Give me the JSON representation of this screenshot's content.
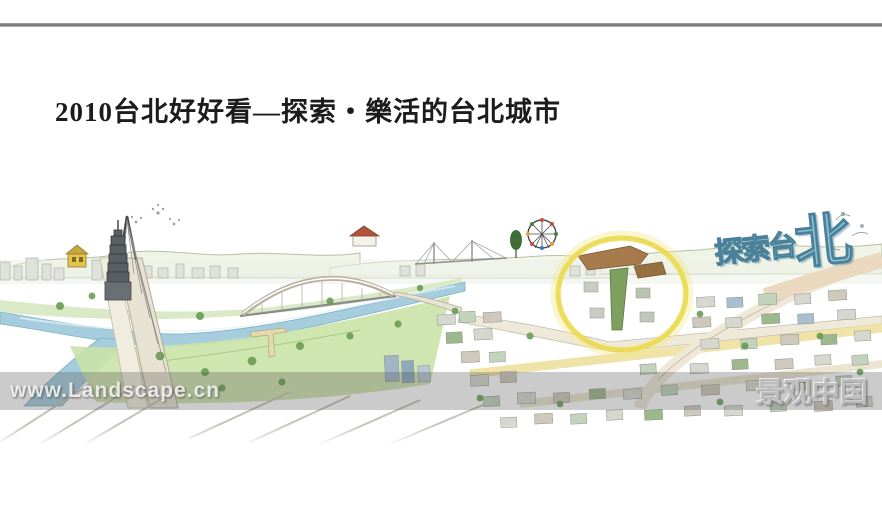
{
  "slide": {
    "title": "2010台北好好看—探索・樂活的台北城市"
  },
  "watermarks": {
    "left": "www.Landscape.cn",
    "right": "景观中国"
  },
  "illustration": {
    "art_text_small": "探索台",
    "art_text_big": "北",
    "highlight_color": "#ead94e"
  }
}
